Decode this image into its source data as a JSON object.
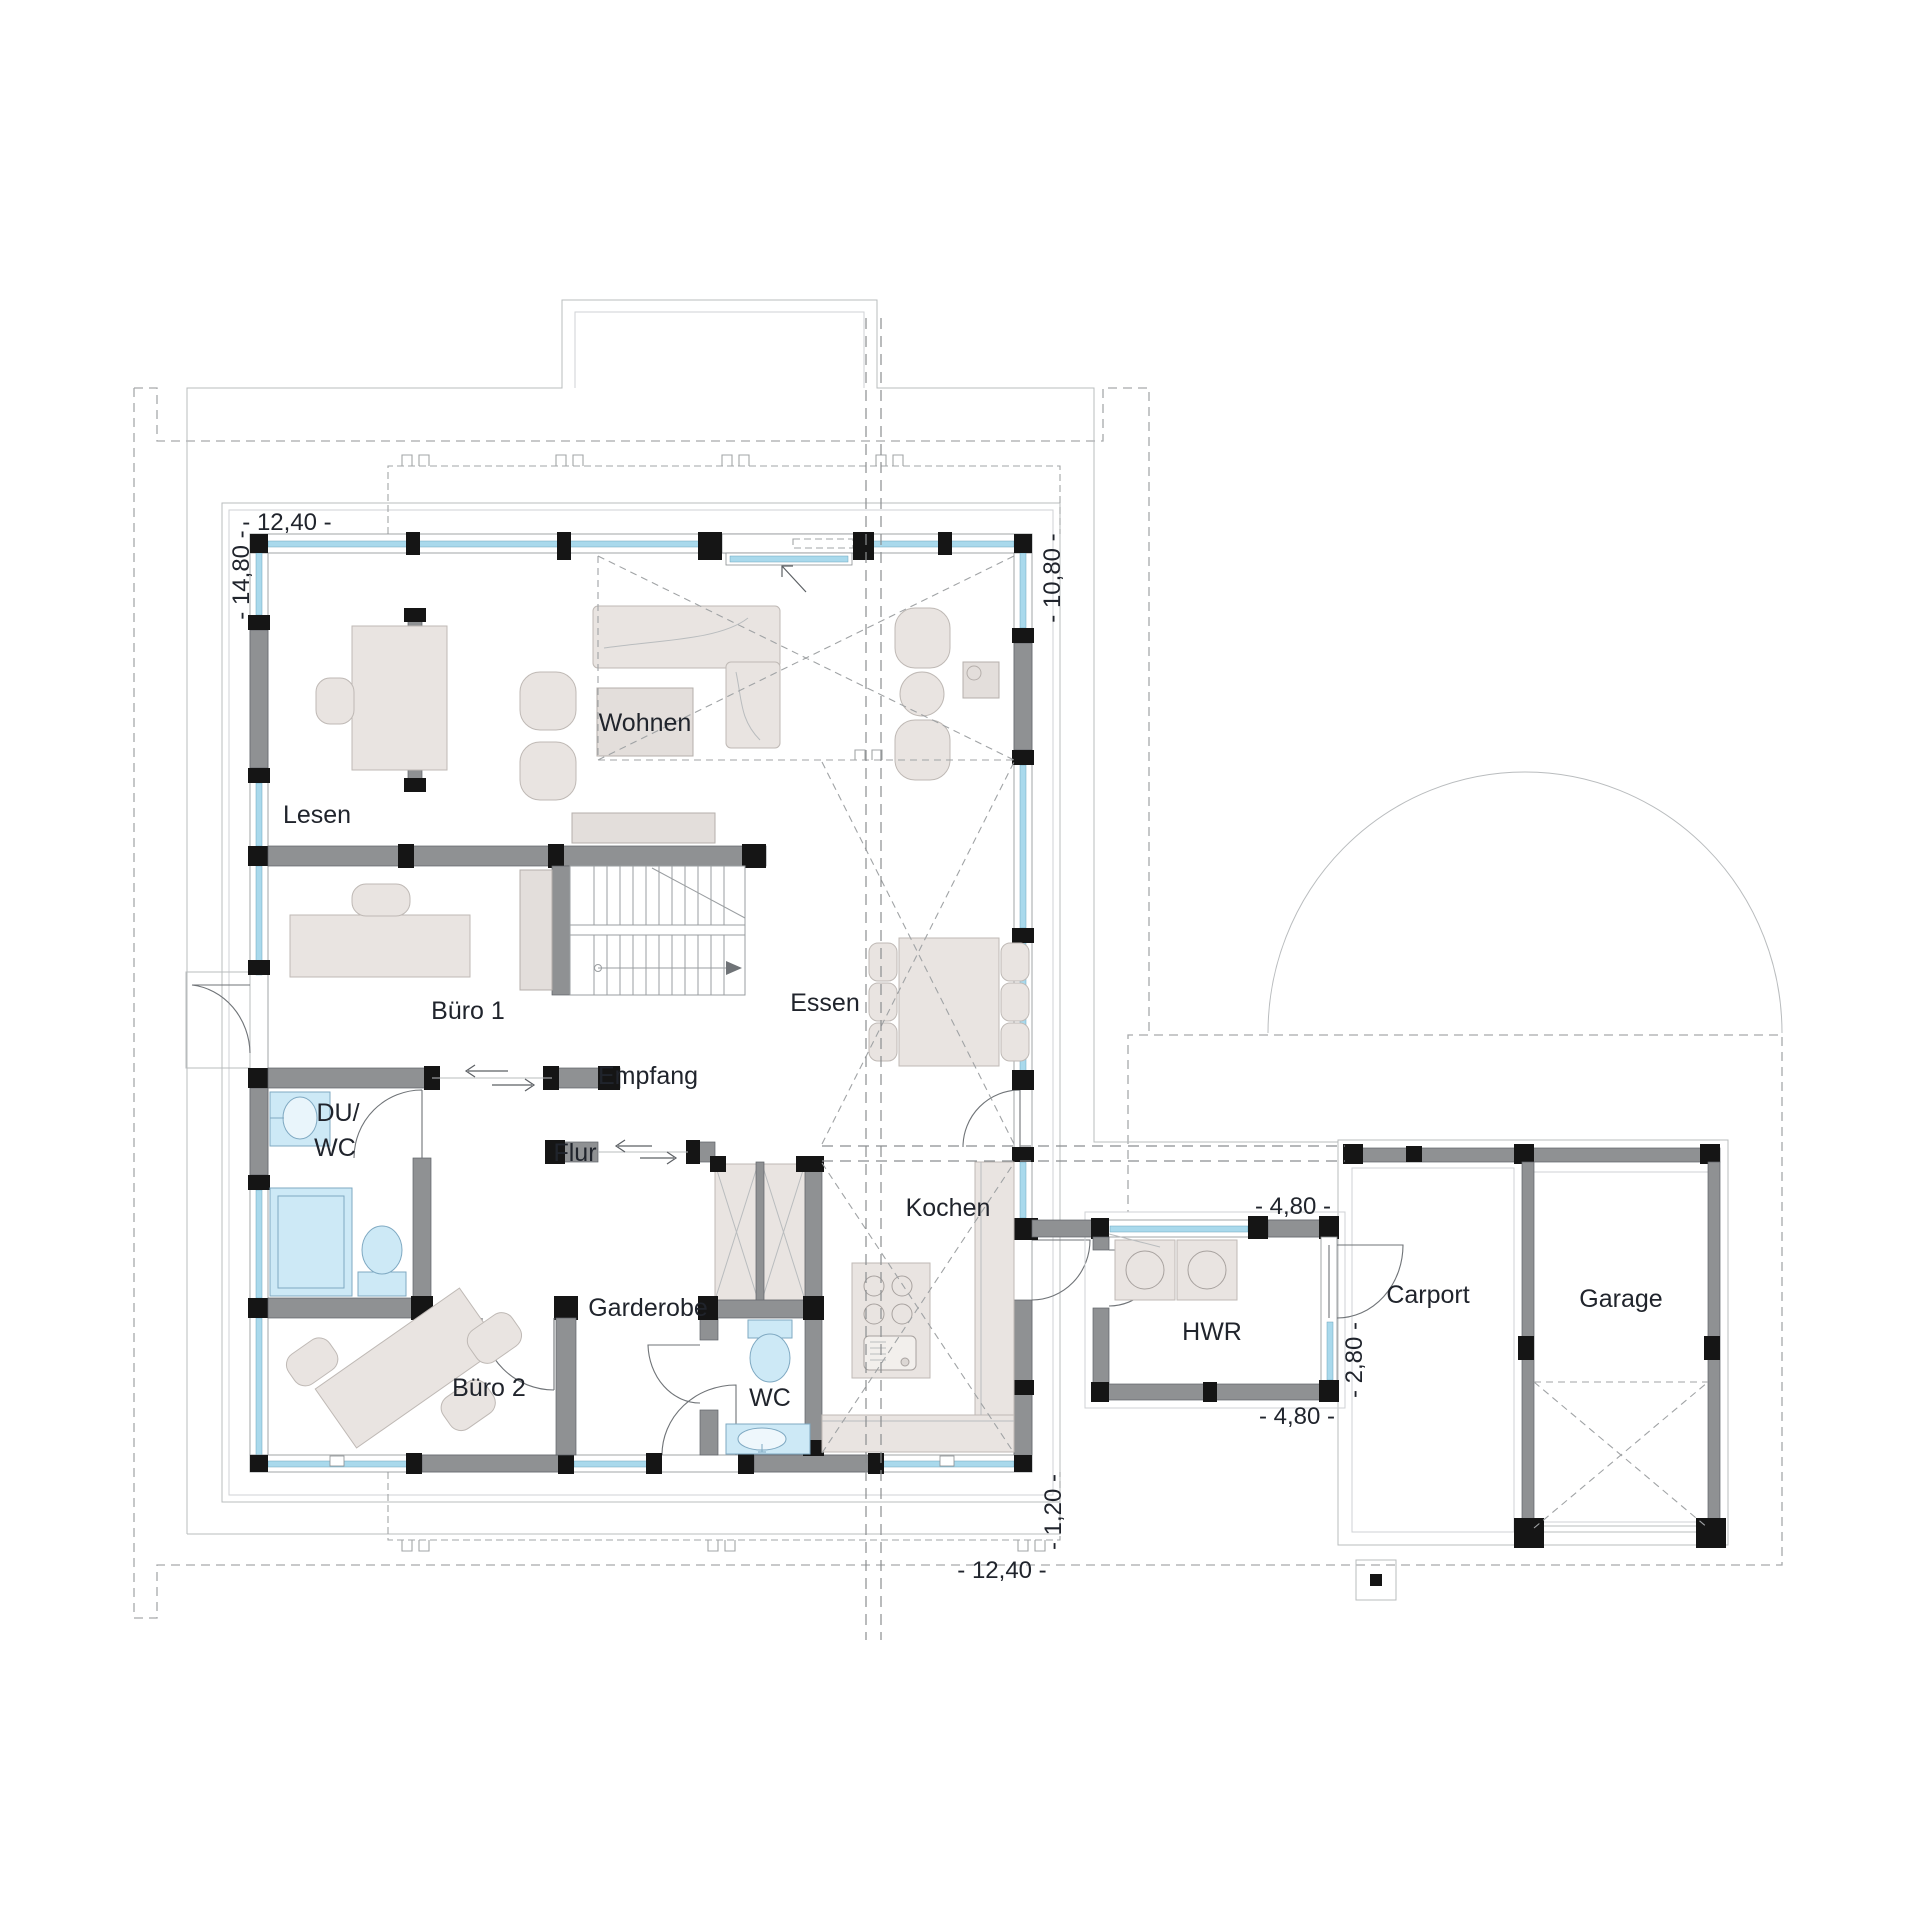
{
  "plan": {
    "type": "floor-plan",
    "language": "de",
    "rooms": {
      "lesen": "Lesen",
      "wohnen": "Wohnen",
      "buero1": "Büro 1",
      "buero2": "Büro 2",
      "essen": "Essen",
      "empfang": "Empfang",
      "flur": "Flur",
      "duwc_line1": "DU/",
      "duwc_line2": "WC",
      "garderobe": "Garderobe",
      "wc": "WC",
      "kochen": "Kochen",
      "hwr": "HWR",
      "carport": "Carport",
      "garage": "Garage"
    },
    "dimensions": {
      "top_width": "- 12,40 -",
      "left_height": "- 14,80 -",
      "right_height": "- 10,80 -",
      "hwr_top": "- 4,80 -",
      "hwr_right": "- 2,80 -",
      "hwr_bottom": "- 4,80 -",
      "bottom_offset": "- 1,20 -",
      "bottom_width": "- 12,40 -"
    },
    "colors": {
      "wall": "#8f9193",
      "column": "#151515",
      "window_glass": "#a9d9ec",
      "fixture_blue": "#cde9f6",
      "furniture": "#e9e4e1",
      "line_gray": "#a6a9ab",
      "text": "#20242c"
    }
  }
}
